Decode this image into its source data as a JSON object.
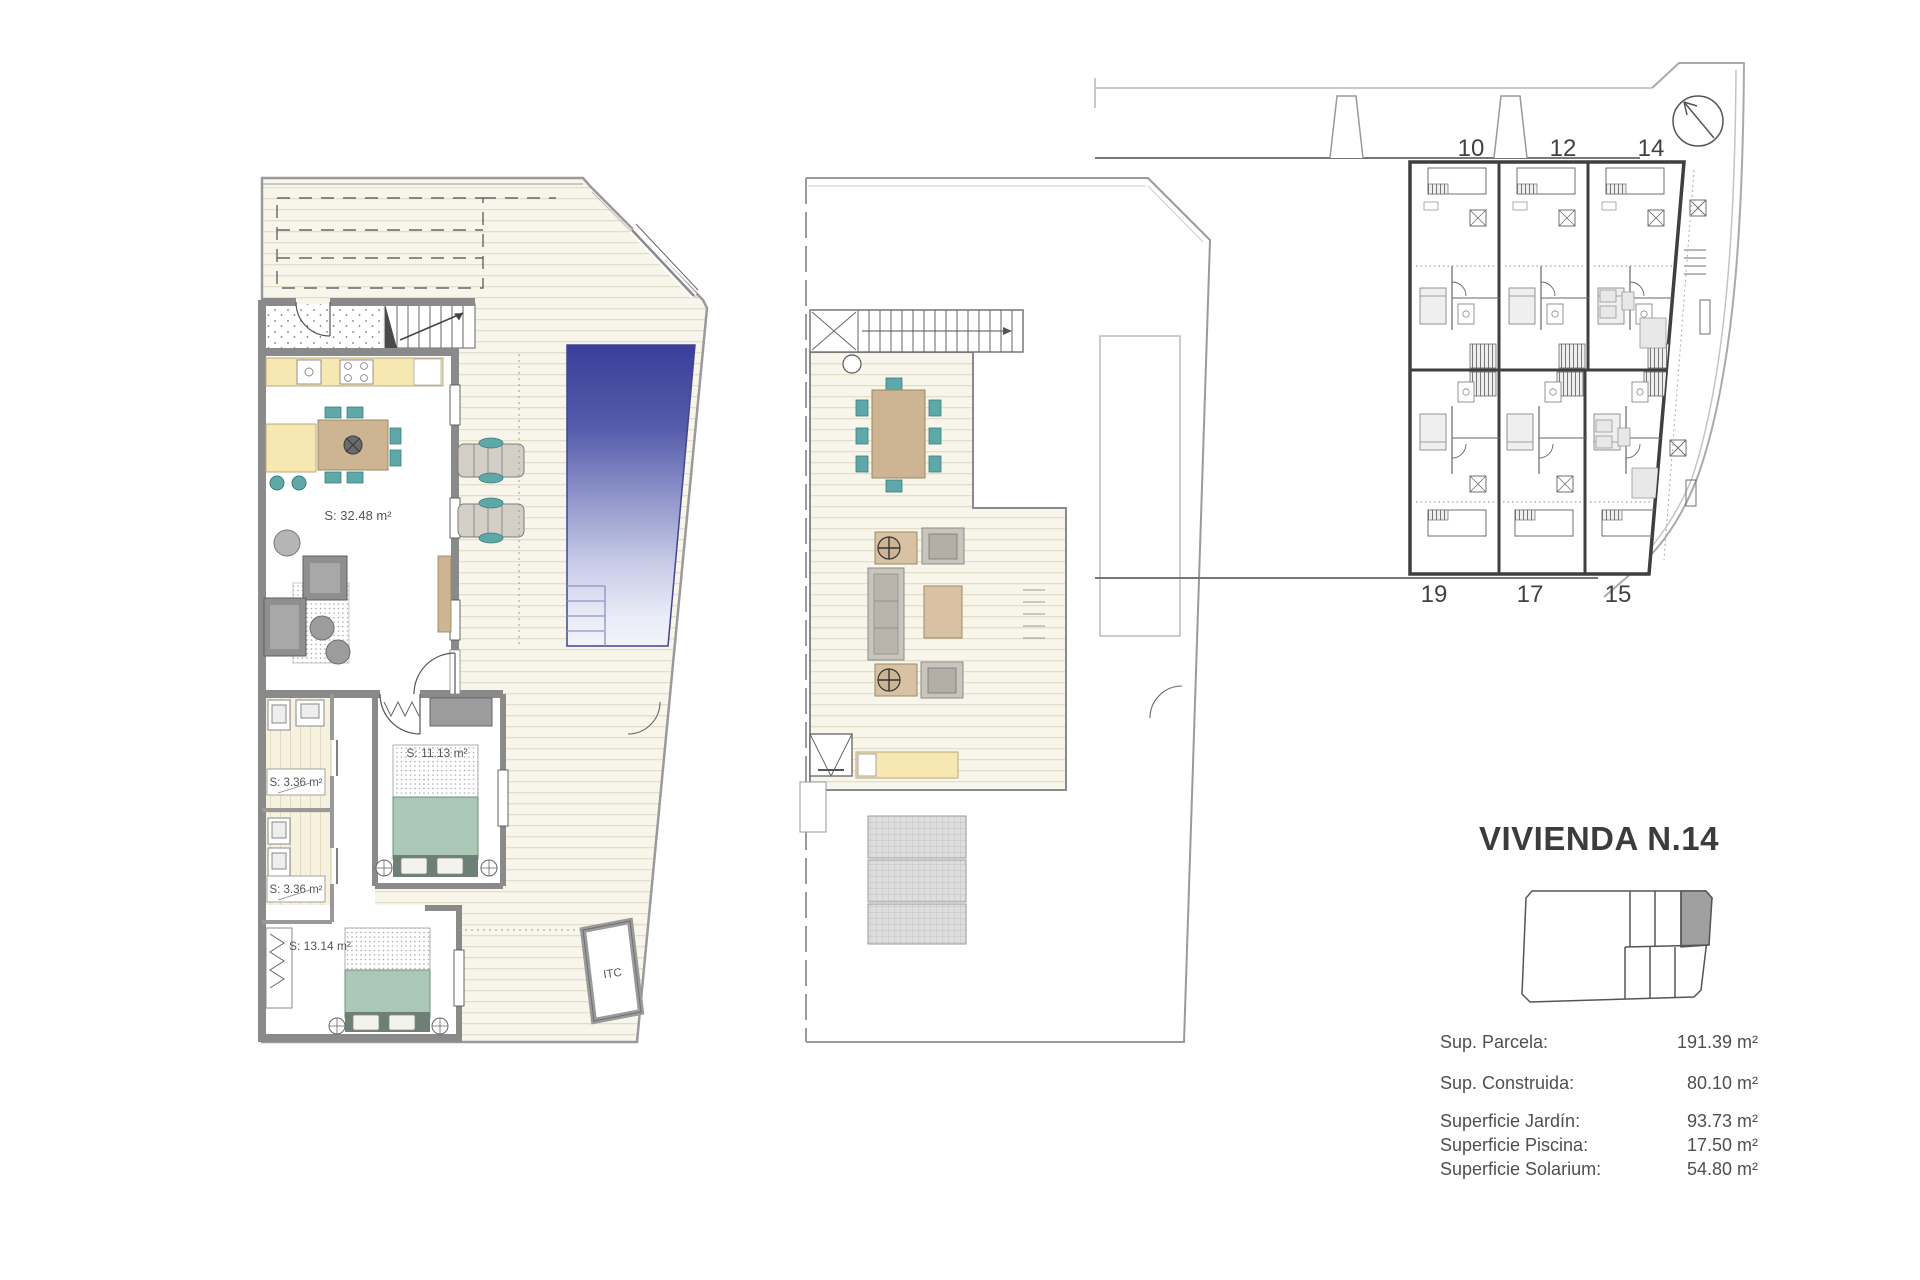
{
  "panel": {
    "title": "VIVIENDA N.14",
    "specs": [
      {
        "label": "Sup. Parcela:",
        "value": "191.39 m²"
      },
      {
        "label": "Sup. Construida:",
        "value": "80.10 m²"
      },
      {
        "label": "Superficie Jardín:",
        "value": "93.73 m²"
      },
      {
        "label": "Superficie Piscina:",
        "value": "17.50 m²"
      },
      {
        "label": "Superficie Solarium:",
        "value": "54.80 m²"
      }
    ]
  },
  "ground_floor": {
    "labels": {
      "living": "S: 32.48 m²",
      "bath1": "S: 3.36 m²",
      "bath2": "S: 3.36 m²",
      "bedroom1": "S: 11.13 m²",
      "bedroom2": "S: 13.14 m²",
      "itc": "ITC"
    }
  },
  "site_plan": {
    "units": [
      "10",
      "12",
      "14",
      "19",
      "17",
      "15"
    ]
  },
  "colors": {
    "pool_top": "#3a3e99",
    "pool_bottom": "#f2f3fa",
    "deck_bg": "#f8f5ea",
    "deck_line": "#ded8c2",
    "wall_gray": "#8a8a8a",
    "counter_yellow": "#f7e8b2",
    "wood_tan": "#cdb493",
    "chair_teal": "#5fa8a8",
    "bed_sage": "#abc7b5",
    "highlight_unit_gray": "#a0a0a0",
    "text_gray": "#4f4f4f"
  }
}
